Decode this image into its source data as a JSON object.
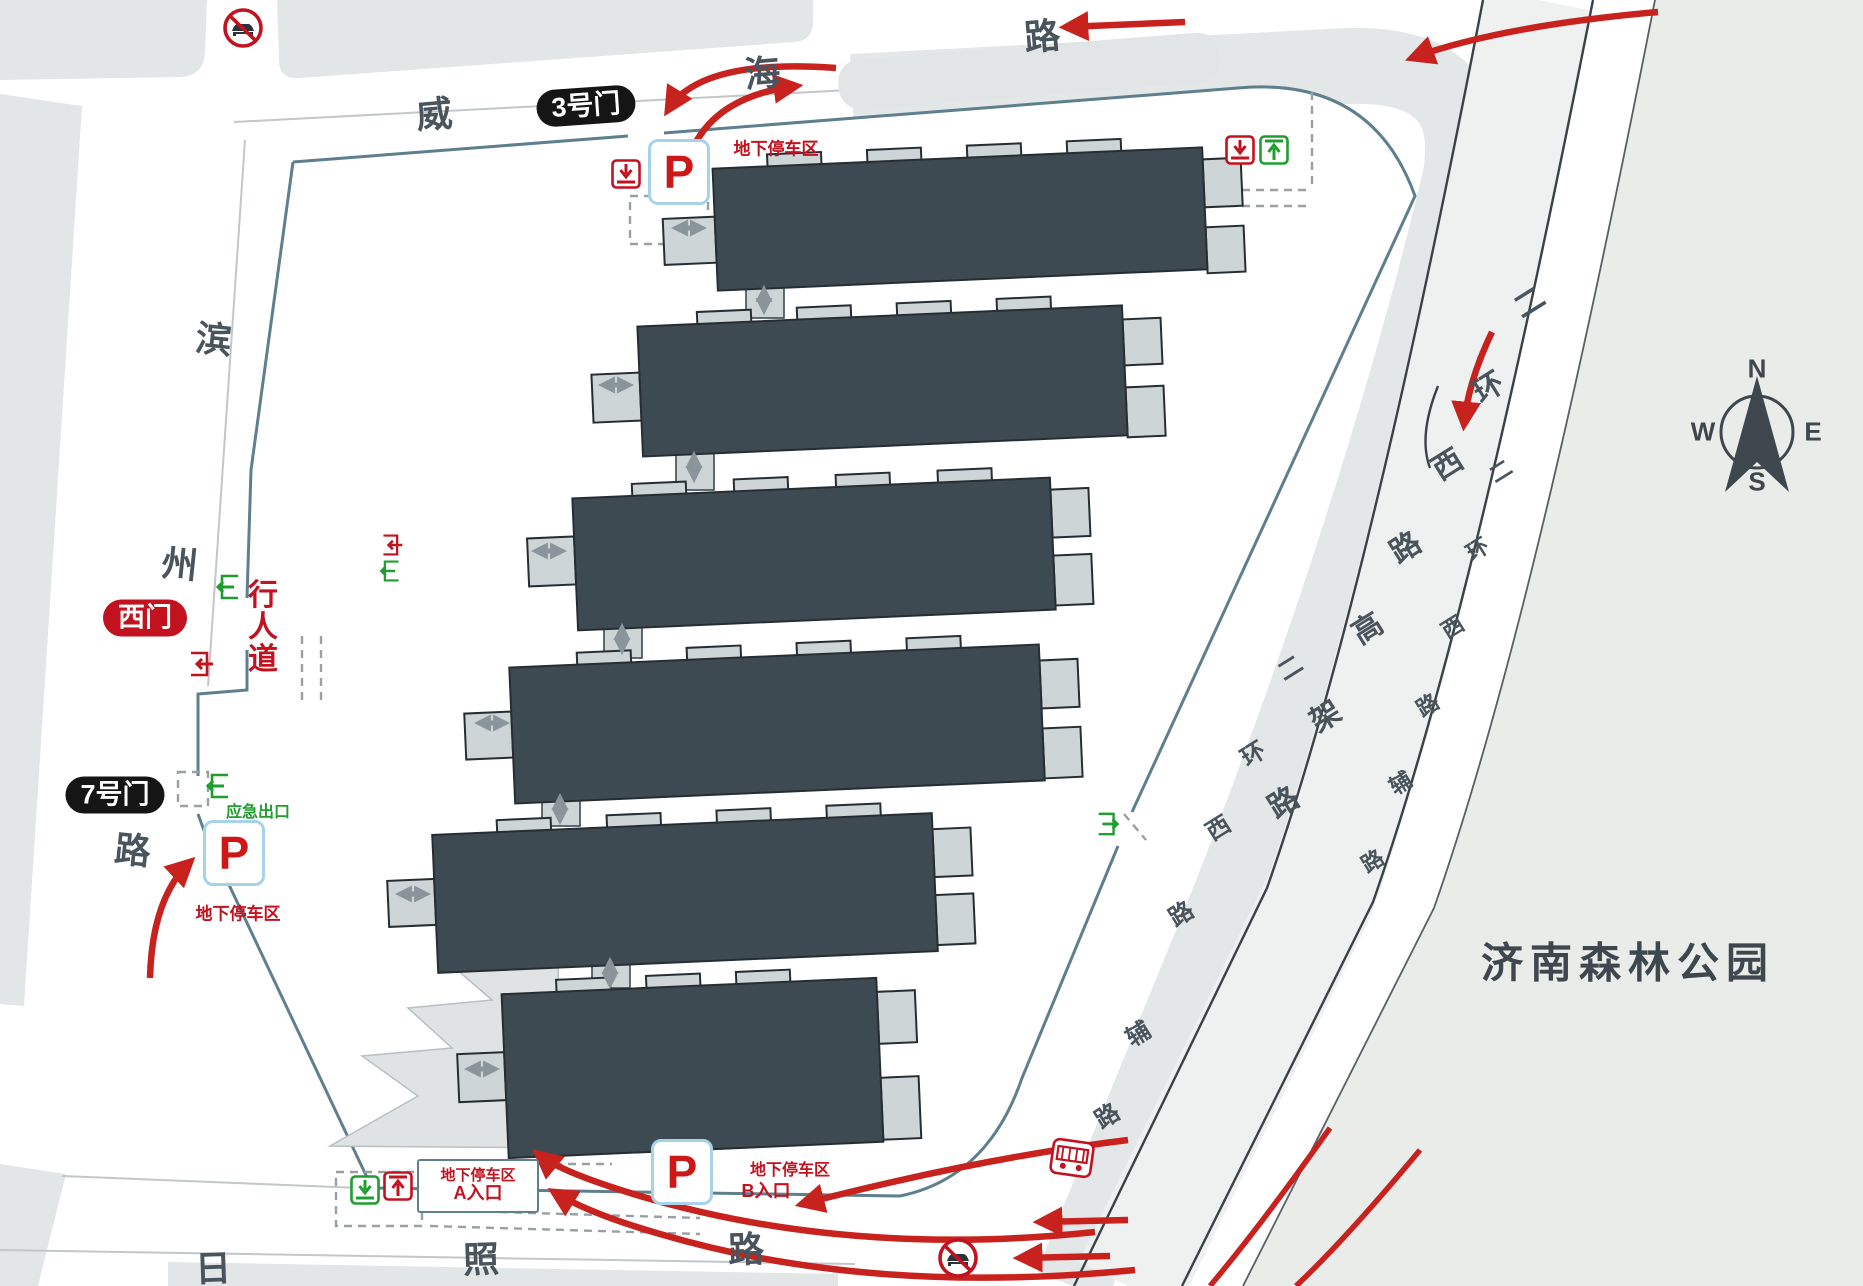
{
  "compass": {
    "north": "N",
    "south": "S",
    "east": "E",
    "west": "W"
  },
  "park_label": "济南森林公园",
  "roads": {
    "weihai_chars": [
      "威",
      "海",
      "路"
    ],
    "binzhou_chars": [
      "滨",
      "州",
      "路"
    ],
    "rizhao_chars": [
      "日",
      "照",
      "路"
    ],
    "ring_inner_chars": [
      "二",
      "环",
      "西",
      "路",
      "辅",
      "路"
    ],
    "ring_elevated_chars": [
      "二",
      "环",
      "西",
      "路",
      "高",
      "架",
      "路"
    ],
    "ring_outer_chars": [
      "二",
      "环",
      "西",
      "路",
      "辅",
      "路"
    ]
  },
  "gates": {
    "gate3_label": "3号门",
    "gate7_label": "7号门",
    "west_gate_label": "西门"
  },
  "parking": {
    "symbol": "P",
    "area_label": "地下停车区",
    "area_label_top": "地下停车区",
    "area_label_west": "地下停车区",
    "area_label_a": "地下停车区",
    "area_label_b": "地下停车区",
    "entrance_a_label": "A入口",
    "entrance_b_label": "B入口"
  },
  "labels": {
    "pedestrian_chars": [
      "行",
      "人",
      "道"
    ],
    "emergency_exit": "应急出口"
  },
  "icons": {
    "no_car": "no-car-icon",
    "car_entry": "car-entry-icon",
    "car_exit": "car-exit-icon",
    "door_exit": "door-exit-icon",
    "bus_stop": "bus-stop-icon",
    "compass": "compass-icon"
  },
  "colors": {
    "arrow_red": "#c8221f",
    "badge_red": "#c3121f",
    "green": "#1f9d2f",
    "boundary_teal": "#5e7f8d",
    "building": "#3e4a52",
    "park_bg": "#e9ece9"
  }
}
